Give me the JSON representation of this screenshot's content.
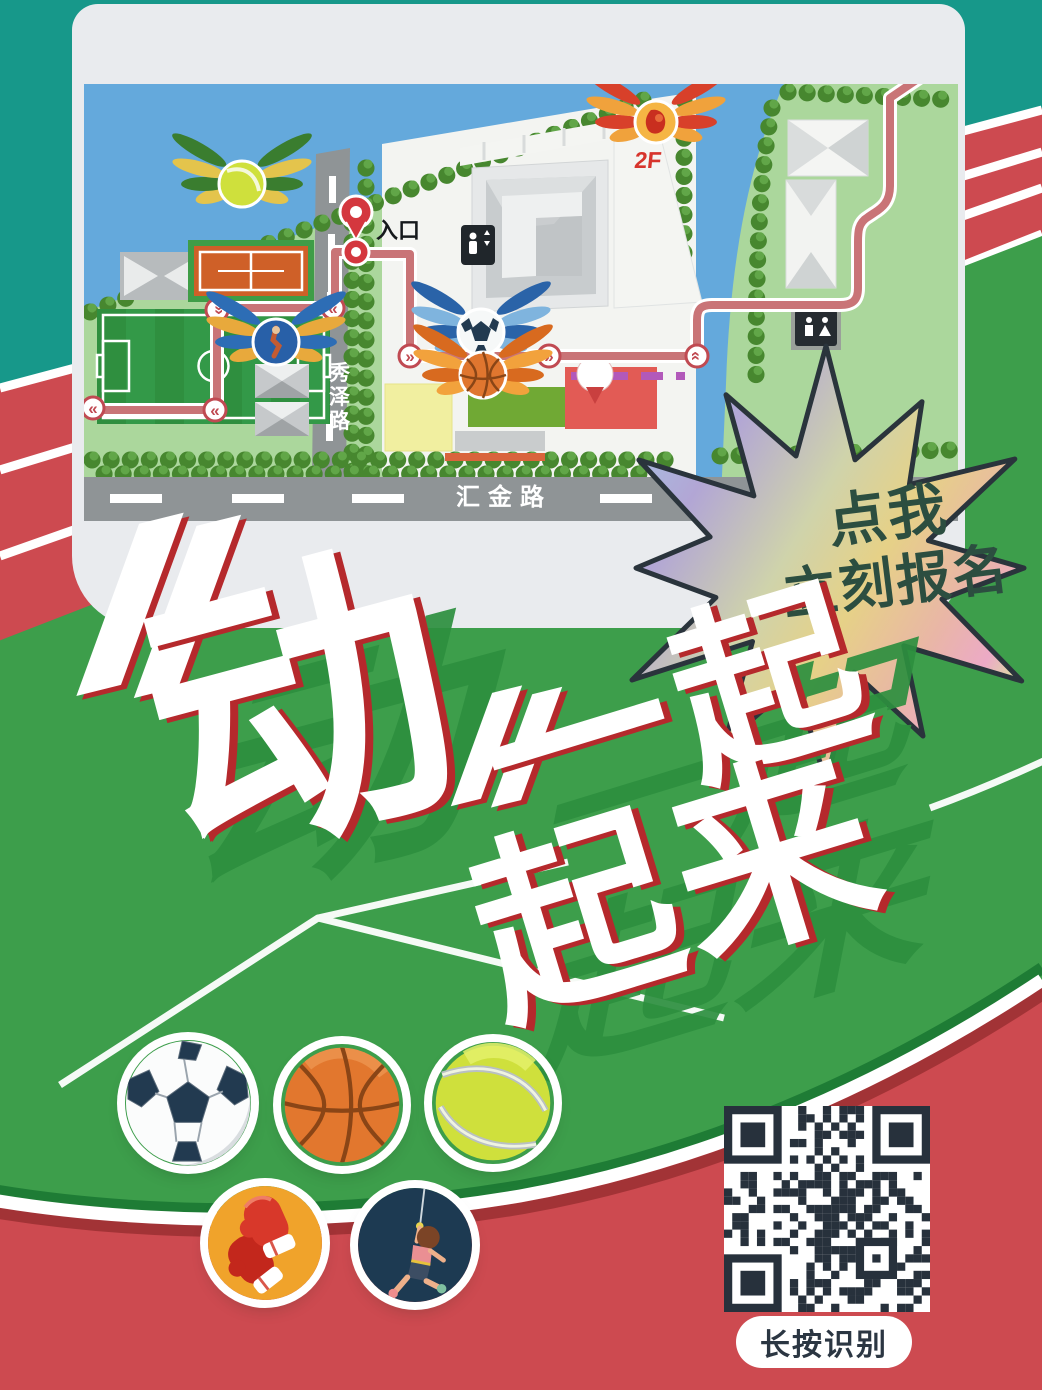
{
  "map": {
    "entrance_label": "入口",
    "floor_label": "2F",
    "road_vertical": "秀泽路",
    "road_horizontal": "汇金路",
    "icons": [
      "entrance-pin",
      "winged-tennis-ball",
      "winged-climber-badge",
      "winged-soccer-ball",
      "winged-basketball",
      "winged-2f-badge",
      "elevator-sign",
      "restroom-sign",
      "route-arrow"
    ]
  },
  "headline": {
    "quote_open": "〝",
    "char1": "动",
    "quote_close": "〞",
    "line1": "一起",
    "line2": "起来",
    "full_text": "〝动〞一起起来"
  },
  "star": {
    "line1": "点我",
    "line2": "立刻报名"
  },
  "qr": {
    "caption": "长按识别"
  },
  "sports_icons": [
    "soccer-ball",
    "basketball",
    "tennis-ball",
    "boxing-gloves",
    "rock-climbing"
  ],
  "colors": {
    "teal": "#17988a",
    "track_red": "#cd4a50",
    "track_red_dark": "#a23336",
    "field_green": "#3d9e4b",
    "field_green_dark": "#1e7c35",
    "card_gray": "#e9ebee",
    "map_sky": "#64a9dc",
    "park_green": "#abd79c",
    "road_gray": "#8f9496",
    "route_rose": "#c97477",
    "headline_red_edge": "#b5292c",
    "headline_shadow_green": "#2d8f3f",
    "star_text_green": "#2c4e40",
    "qr_dark": "#27313c"
  }
}
